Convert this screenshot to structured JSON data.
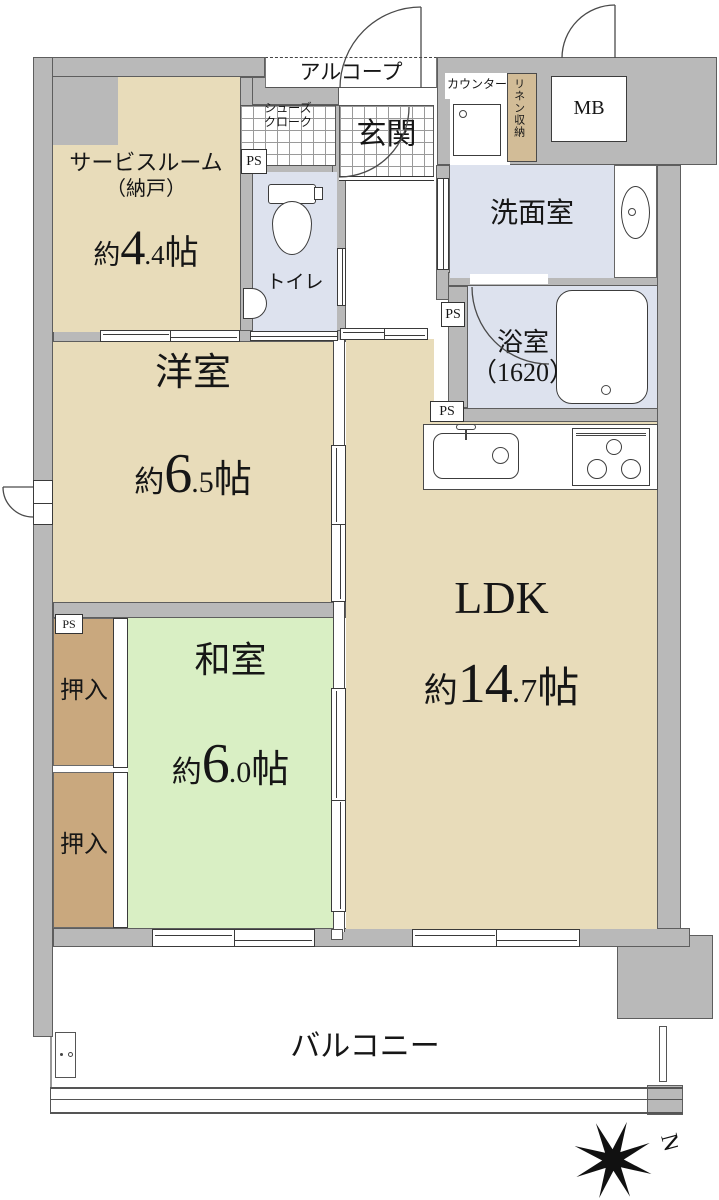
{
  "floorplan": {
    "rooms": {
      "service_room": {
        "name": "サービスルーム",
        "name2": "（納戸）",
        "approx": "約",
        "size_big": "4",
        "size_dec": ".4",
        "unit": "帖"
      },
      "western_room": {
        "name": "洋室",
        "approx": "約",
        "size_big": "6",
        "size_dec": ".5",
        "unit": "帖"
      },
      "ldk": {
        "name": "LDK",
        "approx": "約",
        "size_big": "14",
        "size_dec": ".7",
        "unit": "帖"
      },
      "japanese_room": {
        "name": "和室",
        "approx": "約",
        "size_big": "6",
        "size_dec": ".0",
        "unit": "帖"
      },
      "toilet": {
        "name": "トイレ"
      },
      "washroom": {
        "name": "洗面室"
      },
      "bathroom": {
        "name": "浴室",
        "size": "（1620）"
      },
      "genkan": {
        "name": "玄関"
      },
      "balcony": {
        "name": "バルコニー"
      }
    },
    "features": {
      "alcove": "アルコープ",
      "shoes_closet_line1": "シューズ",
      "shoes_closet_line2": "クローク",
      "counter": "カウンター",
      "linen_storage": "リネン収納",
      "meter_box": "MB",
      "closet_upper": "押入",
      "closet_lower": "押入",
      "ps_1": "PS",
      "ps_2": "PS",
      "ps_3": "PS",
      "ps_4": "PS",
      "compass_north": "N"
    },
    "colors": {
      "wall": "#b9b9b9",
      "wall_outline": "#5e5e5e",
      "room_beige": "#e8dcba",
      "room_green": "#d9efc4",
      "room_blue": "#dde2ee",
      "closet_brown": "#c9a87e",
      "linen_tan": "#d2bc97"
    }
  }
}
